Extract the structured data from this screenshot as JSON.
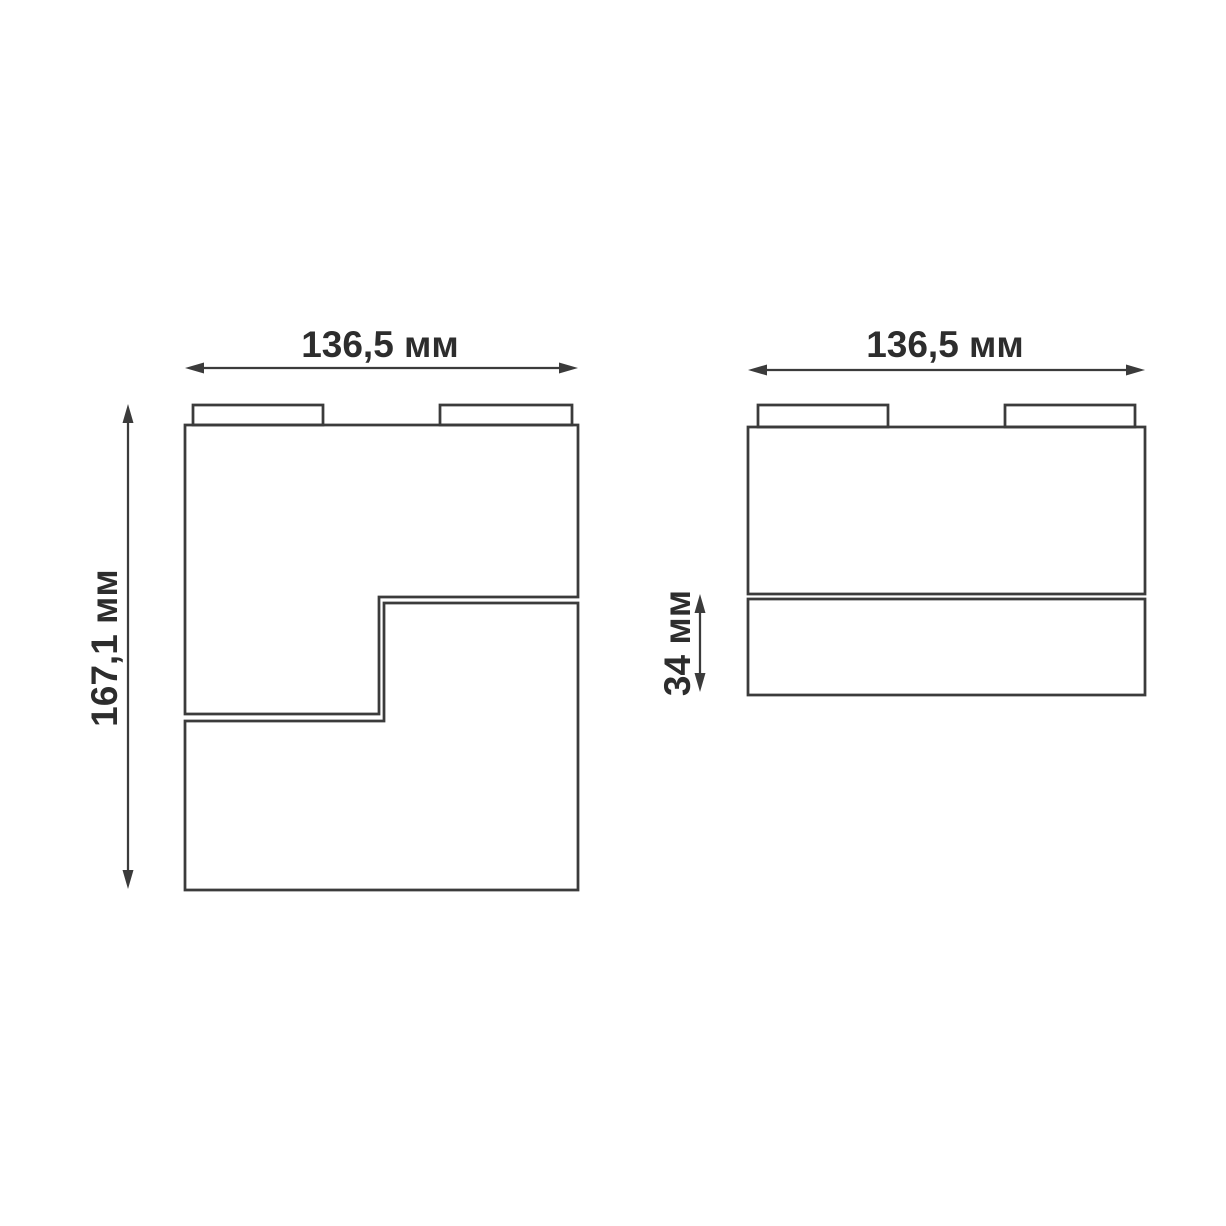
{
  "diagram": {
    "type": "technical-dimension-drawing",
    "description": "Two orthographic views of a track light fixture with dimension callouts",
    "colors": {
      "background": "#ffffff",
      "line": "#3b3b3b",
      "text": "#2d2d2d"
    },
    "front_view": {
      "width_label": "136,5 мм",
      "height_label": "167,1 мм"
    },
    "side_view": {
      "width_label": "136,5 мм",
      "lower_section_height_label": "34 мм"
    }
  }
}
